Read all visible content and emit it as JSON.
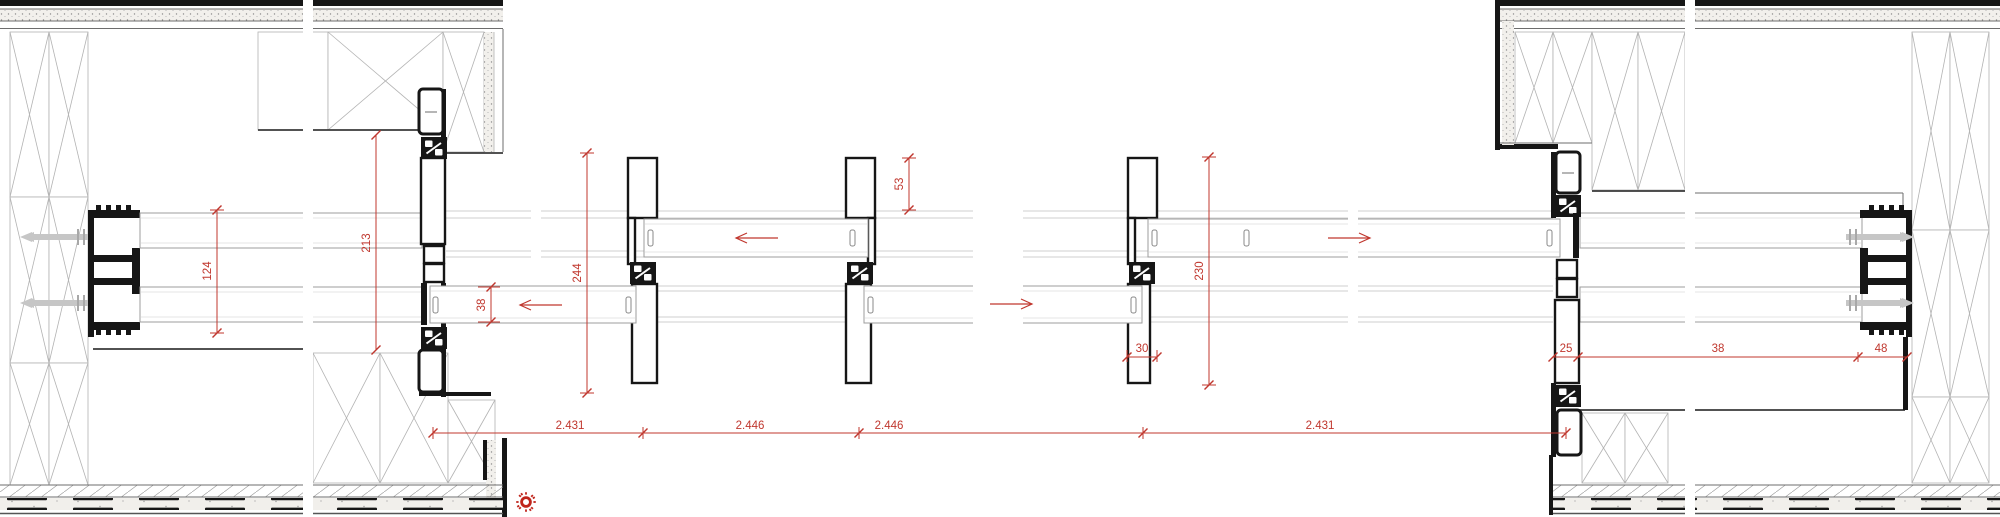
{
  "colors": {
    "dimension_red": "#c0372e",
    "sun_red": "#c0251c",
    "profile_black": "#161616",
    "hatch_grey": "#b3b3b3"
  },
  "dimensions": {
    "v124": "124",
    "v213": "213",
    "v38": "38",
    "v244": "244",
    "v53": "53",
    "v230": "230",
    "h30": "30",
    "chain": [
      "2.431",
      "2.446",
      "2.446",
      "2.431"
    ],
    "right_chain": [
      "25",
      "38",
      "48"
    ]
  }
}
